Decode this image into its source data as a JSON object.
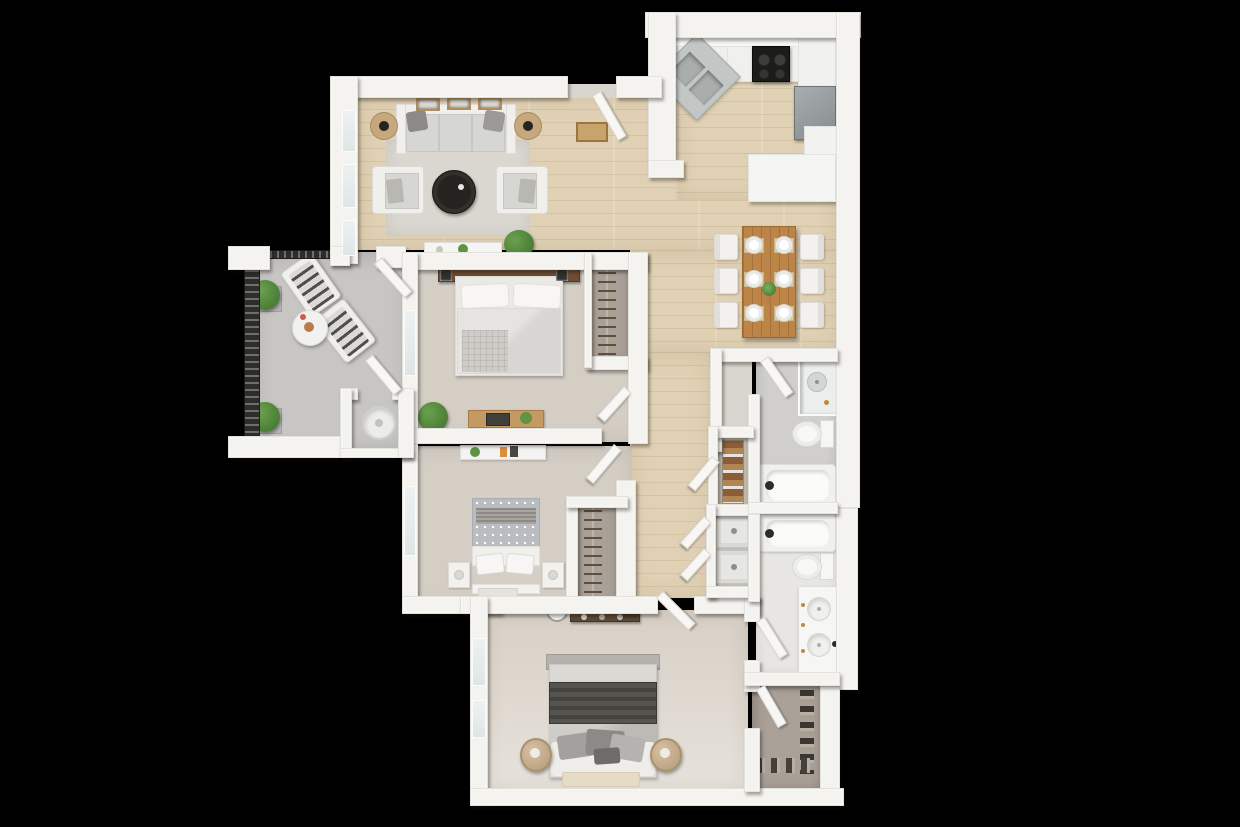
{
  "meta": {
    "type": "3d-floor-plan-top-down-render",
    "width": 1240,
    "height": 827,
    "visible_text": "none"
  },
  "palette": {
    "bg": "#000000",
    "wall": "#f4f3f0",
    "wallEdge": "#e3e1dc",
    "door": "#f8f7f4",
    "doorEdge": "#d9d7d2",
    "wood": "#e0d1b4",
    "woodSeam": "#c9b795",
    "carpet": "#d4cec5",
    "carpetWarm": "#d8d0c6",
    "concrete": "#c7c6c3",
    "bathGray": "#d0cfcc",
    "bathLight": "#e8e6e2",
    "closetGray": "#a9a198",
    "vestibule": "#d8d4ce",
    "rug": "#dad7d0",
    "rugTan": "#e6dcc6",
    "sofaFrame": "#f0efec",
    "cushion": "#d6d6d3",
    "pillowDark": "#8b8a86",
    "charcoal": "#26221f",
    "rattan": "#c7a87e",
    "diningWood": "#bd8448",
    "chair": "#f2f1ee",
    "steel": "#c2c6c5",
    "steelDark": "#a6aaa9",
    "stove": "#1c1c1a",
    "fridge": "#9aa0a2",
    "green": "#5e9444",
    "greenDark": "#3e6f2d",
    "headboard": "#6f4d34",
    "headboardGray": "#b5b1ac",
    "bedWhite": "#efedea",
    "bedGray": "#dbd9d6",
    "throwDark": "#514f4b",
    "towelDark": "#8a5c39",
    "towelLight": "#b08555",
    "mat": "#c8a36a",
    "railing": "#2e2d2b"
  },
  "scene": {
    "background": "#000000",
    "rooms": [
      {
        "name": "living-room",
        "floor": "wood",
        "furniture": [
          "three-seat-sofa",
          "two-throw-pillows",
          "two-rattan-end-tables-with-lamps",
          "two-armchairs",
          "round-dark-coffee-table",
          "area-rug",
          "console-table",
          "three-wall-art-frames",
          "potted-plant",
          "entry-doormat"
        ]
      },
      {
        "name": "kitchen",
        "floor": "wood",
        "furniture": [
          "corner-double-stainless-sink",
          "black-range-stove",
          "upper-and-lower-counters",
          "refrigerator",
          "peninsula-counter"
        ]
      },
      {
        "name": "dining-area",
        "floor": "wood",
        "furniture": [
          "rectangular-wood-table",
          "six-white-chairs",
          "six-place-settings-with-plates",
          "centerpiece-plant"
        ]
      },
      {
        "name": "bedroom-1",
        "floor": "carpet",
        "furniture": [
          "double-bed",
          "wood-headboard",
          "two-wall-art-frames",
          "two-headboard-lamps",
          "knit-throw",
          "desk-with-laptop-and-plant",
          "potted-plant",
          "reach-in-closet-with-hangers"
        ]
      },
      {
        "name": "bedroom-2",
        "floor": "carpet",
        "furniture": [
          "double-bed-polka-dot-duvet",
          "two-nightstands",
          "wall-shelf-with-books",
          "small-rug",
          "reach-in-closet-with-hangers"
        ]
      },
      {
        "name": "master-bedroom",
        "floor": "carpet",
        "furniture": [
          "king-bed-dark-throw",
          "pillow-cluster",
          "two-round-rattan-nightstands",
          "tv-console",
          "wall-clock",
          "bedside-rug"
        ]
      },
      {
        "name": "bathroom-1",
        "floor": "tile-gray",
        "furniture": [
          "corner-shower",
          "toilet",
          "bathtub"
        ]
      },
      {
        "name": "bathroom-2",
        "floor": "tile-light",
        "furniture": [
          "bathtub",
          "toilet",
          "double-sink-vanity"
        ]
      },
      {
        "name": "walk-in-closet",
        "floor": "gray-carpet",
        "furniture": [
          "shoe-row-right",
          "shoe-row-bottom"
        ]
      },
      {
        "name": "linen-closet",
        "furniture": [
          "towel-shelves"
        ]
      },
      {
        "name": "laundry-closet",
        "furniture": [
          "washer",
          "dryer"
        ]
      },
      {
        "name": "balcony",
        "floor": "concrete",
        "furniture": [
          "metal-railing",
          "two-lounge-chairs",
          "round-side-table-with-vase",
          "two-planter-shrubs",
          "storage-room-with-water-heater"
        ]
      },
      {
        "name": "hallway",
        "floor": "wood",
        "furniture": []
      }
    ],
    "counts": {
      "doors": 10,
      "windows": 7,
      "bedrooms": 3,
      "bathrooms": 2
    }
  }
}
